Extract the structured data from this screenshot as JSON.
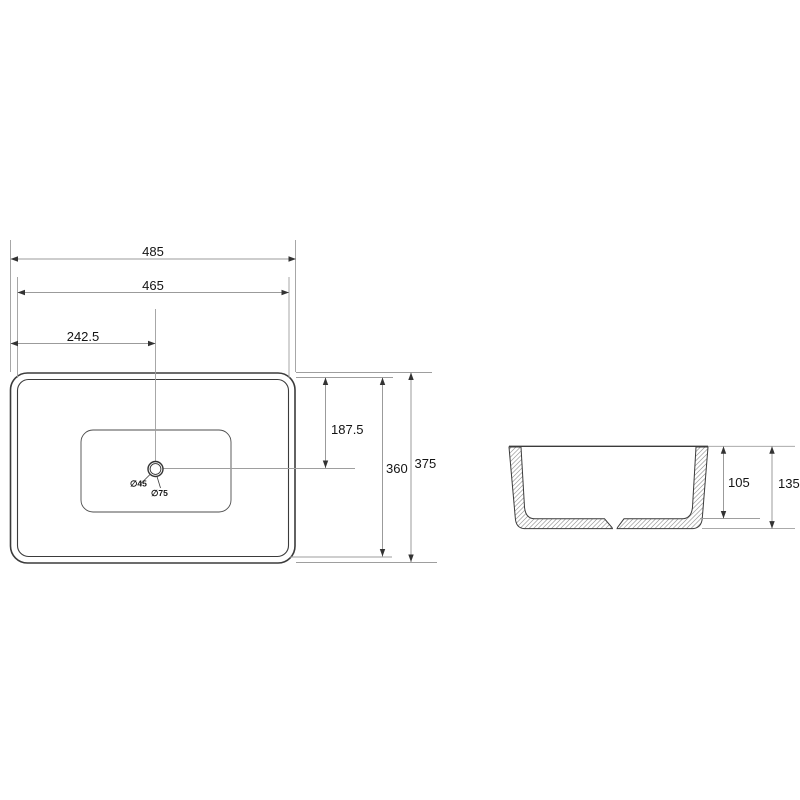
{
  "colors": {
    "background": "#ffffff",
    "outline": "#3b3b3b",
    "dimension_line": "#9b9b9b",
    "label_text": "#141414",
    "hatch": "#9a9a9a",
    "arrowhead": "#333333"
  },
  "top_view": {
    "dimensions": {
      "overall_width": "485",
      "rim_width": "465",
      "drain_offset_x": "242.5",
      "drain_offset_y": "187.5",
      "rim_depth": "360",
      "overall_depth": "375"
    },
    "drain": {
      "small_diameter": "∅45",
      "large_diameter": "∅75"
    }
  },
  "side_view": {
    "dimensions": {
      "bowl_depth": "105",
      "overall_height": "135"
    }
  }
}
